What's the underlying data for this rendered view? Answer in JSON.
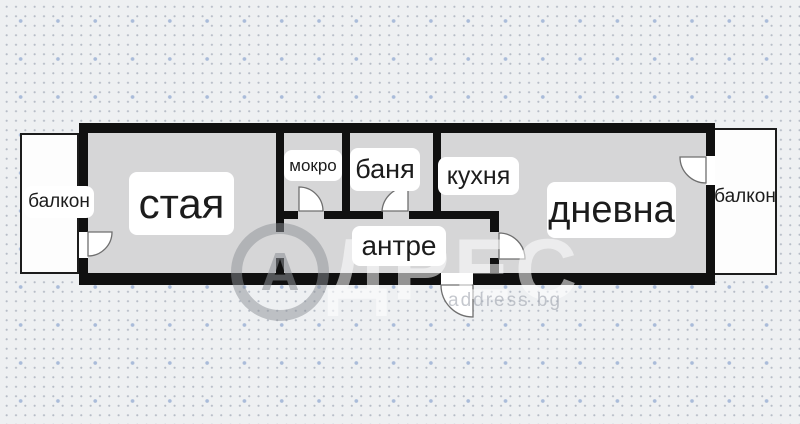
{
  "plan": {
    "rooms": [
      {
        "id": "balcony-left",
        "label": "балкон"
      },
      {
        "id": "staya",
        "label": "стая"
      },
      {
        "id": "mokro",
        "label": "мокро"
      },
      {
        "id": "banya",
        "label": "баня"
      },
      {
        "id": "kuhnya",
        "label": "кухня"
      },
      {
        "id": "dnevna",
        "label": "дневна"
      },
      {
        "id": "antre",
        "label": "антре"
      },
      {
        "id": "balcony-right",
        "label": "балкон"
      }
    ],
    "watermark": {
      "logo_letter": "А",
      "text": "ДРЕС",
      "subtext": "address.bg"
    },
    "colors": {
      "wall": "#101010",
      "floor": "#d6d6d7",
      "background": "#eef0f2",
      "balcony_fill": "#fdfdfd",
      "dot_small": "#b7bdc7",
      "dot_big": "#a9bbd9",
      "label_bg": "#ffffff",
      "label_text": "#1c1c1c"
    }
  }
}
